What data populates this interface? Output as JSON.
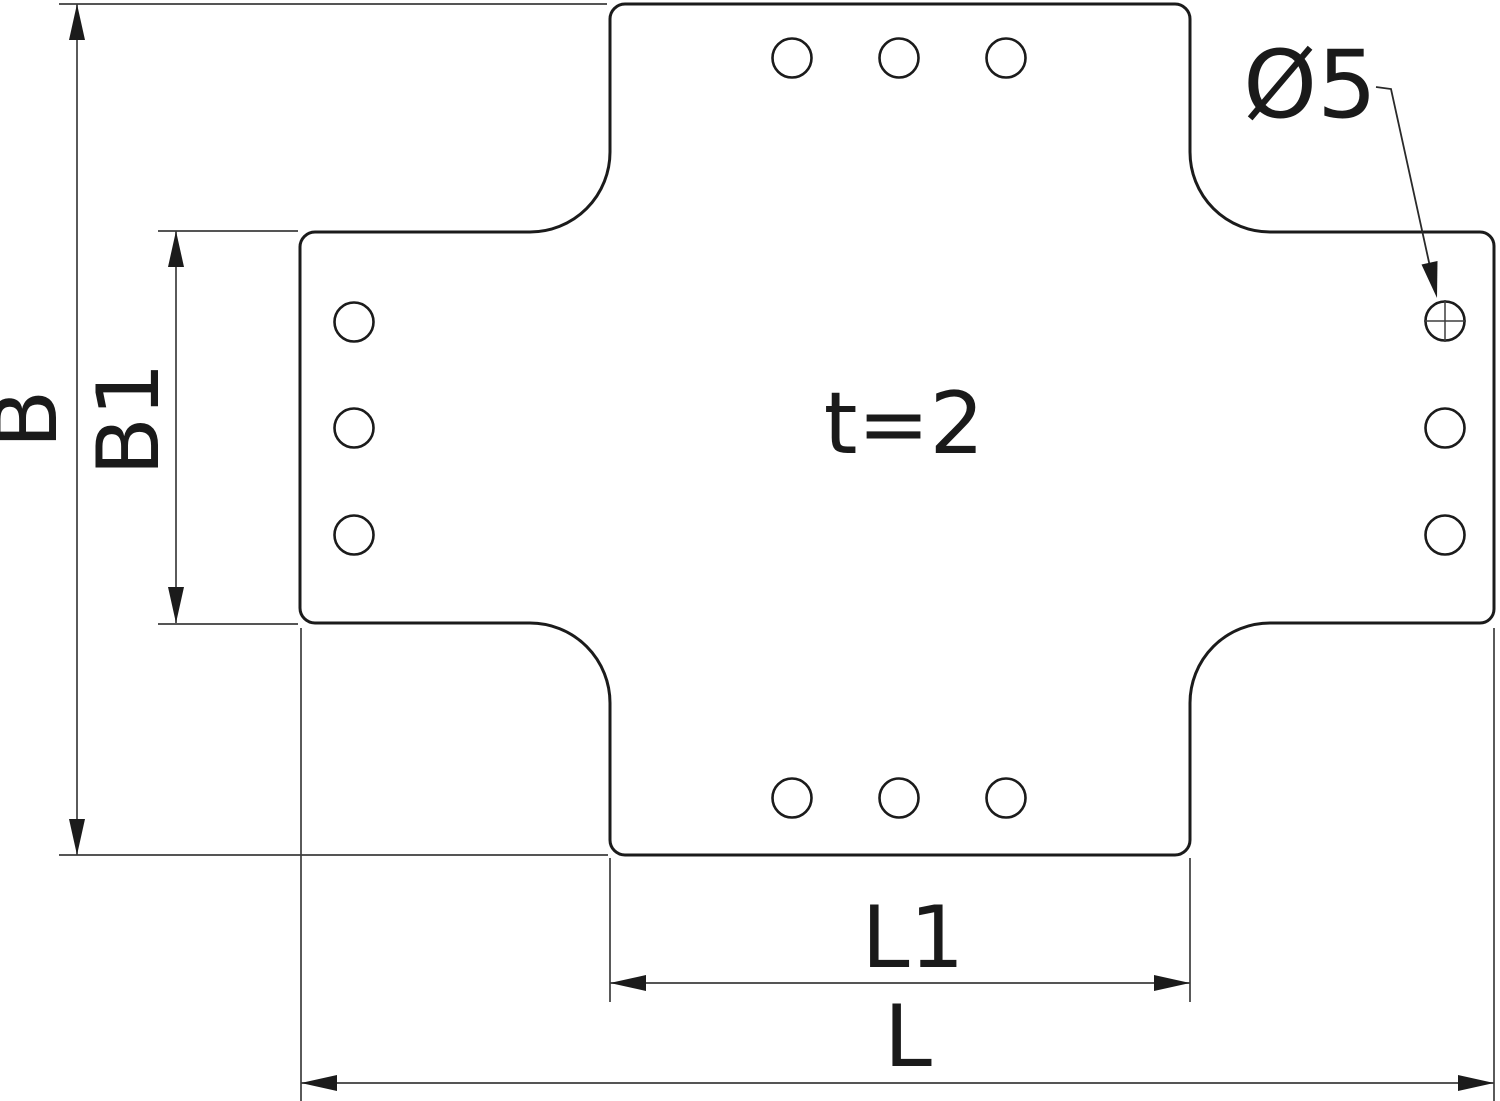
{
  "drawing": {
    "kind": "technical dimension drawing",
    "part": "flat cross connector plate",
    "background": "#ffffff",
    "outline_color": "#1b1b1b",
    "dimension_color": "#3d3d3d",
    "text_color": "#1a1a1a",
    "holes_per_arm": 3,
    "holes_total": 12
  },
  "labels": {
    "b": "B",
    "b1": "B1",
    "l1": "L1",
    "l": "L",
    "t": "t=2",
    "dia": "Ø5"
  }
}
